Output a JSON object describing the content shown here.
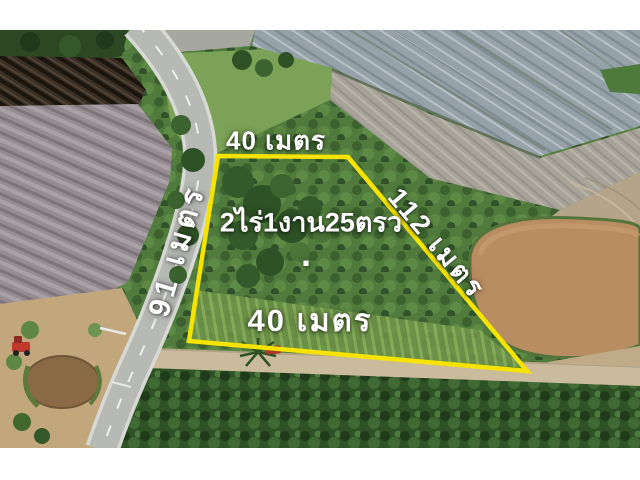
{
  "window": {
    "width": 640,
    "height": 480,
    "letterbox_color": "#ffffff"
  },
  "listing_photo": {
    "kind": "aerial drone photo of a land plot for sale",
    "plot": {
      "outline_color": "#f6e400",
      "label_color": "#ffffff",
      "labels": {
        "top_width": "40 เมตร",
        "area": "2ไร่1งาน25ตรว",
        "area_dot": ".",
        "bottom_width": "40 เมตร",
        "right_depth": "112 เมตร",
        "left_depth": "91 เมตร"
      }
    },
    "scene_colors": {
      "asphalt_road": "#b7b9b5",
      "flooded_paddy_gray": "#96a2a9",
      "muddy_pond_brown": "#b88d62",
      "plowed_field_dark": "#3a2f24",
      "tilled_field_gray": "#958d92",
      "scrub_green": "#507b3c",
      "dirt_track_tan": "#cabb9c",
      "tree_row_green": "#2e5126",
      "tractor_red": "#c0392b"
    }
  }
}
